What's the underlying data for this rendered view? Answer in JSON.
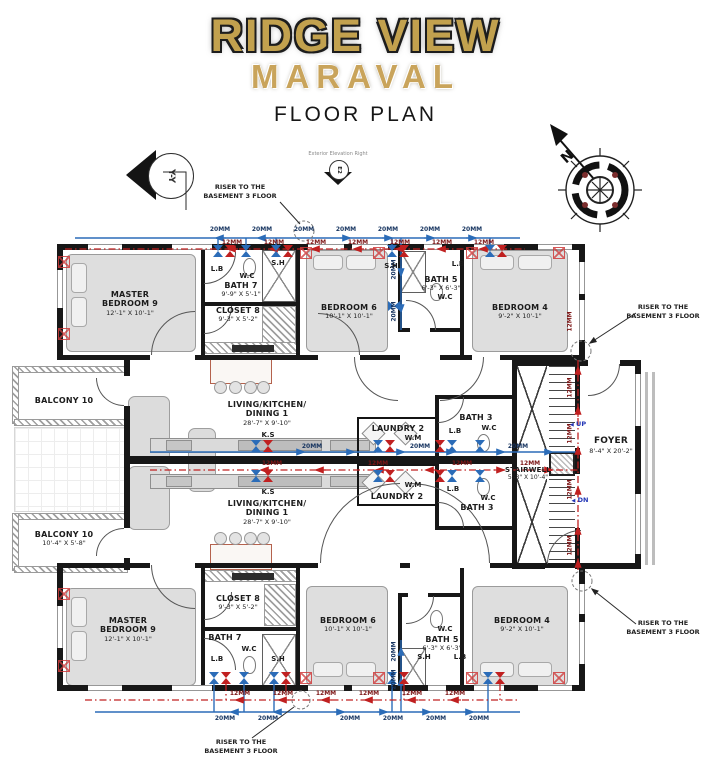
{
  "header": {
    "title": "RIDGE VIEW",
    "subtitle": "MARAVAL",
    "caption": "FLOOR PLAN"
  },
  "markers": {
    "north": "N",
    "section_tag": "Y-Y",
    "elevation_note": "Exterior Elevation Right",
    "elevation_tag": "E2",
    "riser_note_line1": "RISER TO THE",
    "riser_note_line2": "BASEMENT 3 FLOOR"
  },
  "pipes": {
    "cold": "20MM",
    "hot": "12MM"
  },
  "fixtures": {
    "lb": "L.B",
    "wc": "W.C",
    "sh": "S.H",
    "ks": "K.S",
    "wm": "W.M",
    "up": "UP",
    "dn": "DN"
  },
  "icons": {
    "left_arrow": "◀"
  },
  "rooms": {
    "master_top": {
      "name": "MASTER BEDROOM 9",
      "dims": "12'-1\" X 10'-1\""
    },
    "bath7_top": {
      "name": "BATH 7",
      "dims": "9'-9\" X 5'-1\""
    },
    "closet8_top": {
      "name": "CLOSET 8",
      "dims": "9'-3\" X 5'-2\""
    },
    "bedroom6_top": {
      "name": "BEDROOM 6",
      "dims": "10'-1\" X 10'-1\""
    },
    "bath5_top": {
      "name": "BATH 5",
      "dims": "6'-3\" X 6'-3\""
    },
    "bedroom4_top": {
      "name": "BEDROOM 4",
      "dims": "9'-2\" X 10'-1\""
    },
    "balcony_top": {
      "name": "BALCONY 10"
    },
    "balcony_bottom": {
      "name": "BALCONY 10",
      "dims": "10'-4\" X 5'-8\""
    },
    "living_top": {
      "line1": "LIVING/KITCHEN/",
      "line2": "DINING 1",
      "dims": "28'-7\" X 9'-10\""
    },
    "living_bottom": {
      "line1": "LIVING/KITCHEN/",
      "line2": "DINING 1",
      "dims": "28'-7\" X 9'-10\""
    },
    "laundry_top": {
      "name": "LAUNDRY 2"
    },
    "laundry_bottom": {
      "name": "LAUNDRY 2"
    },
    "bath3_top": {
      "name": "BATH 3"
    },
    "bath3_bottom": {
      "name": "BATH 3"
    },
    "stairwell": {
      "name": "STAIRWELL",
      "dims": "5'-8\" X 10'-4\""
    },
    "foyer": {
      "name": "FOYER",
      "dims": "8'-4\" X 20'-2\""
    },
    "master_bottom": {
      "name": "MASTER BEDROOM 9",
      "dims": "12'-1\" X 10'-1\""
    },
    "closet8_bottom": {
      "name": "CLOSET 8",
      "dims": "9'-3\" X 5'-2\""
    },
    "bath7_bottom": {
      "name": "BATH 7"
    },
    "bedroom6_bottom": {
      "name": "BEDROOM 6",
      "dims": "10'-1\" X 10'-1\""
    },
    "bath5_bottom": {
      "name": "BATH 5",
      "dims": "6'-3\" X 6'-3\""
    },
    "bedroom4_bottom": {
      "name": "BEDROOM 4",
      "dims": "9'-2\" X 10'-1\""
    }
  }
}
